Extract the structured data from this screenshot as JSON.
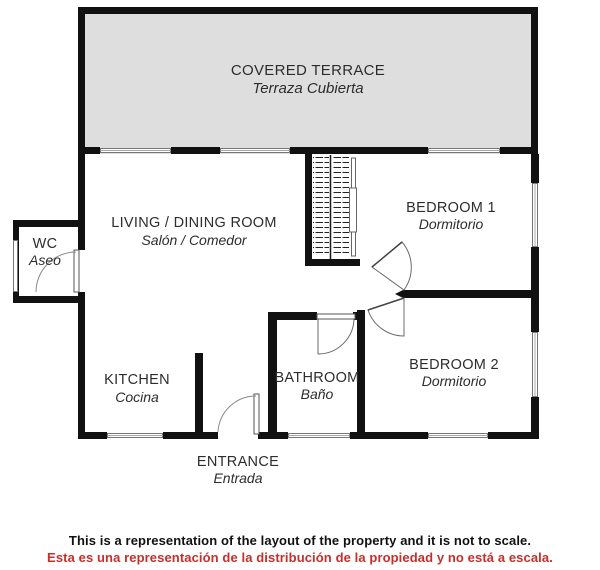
{
  "rooms": {
    "covered_terrace": {
      "label": "COVERED TERRACE",
      "sublabel": "Terraza Cubierta"
    },
    "living_dining": {
      "label": "LIVING / DINING ROOM",
      "sublabel": "Salón / Comedor"
    },
    "wc": {
      "label": "WC",
      "sublabel": "Aseo"
    },
    "bedroom1": {
      "label": "BEDROOM 1",
      "sublabel": "Dormitorio"
    },
    "bedroom2": {
      "label": "BEDROOM 2",
      "sublabel": "Dormitorio"
    },
    "kitchen": {
      "label": "KITCHEN",
      "sublabel": "Cocina"
    },
    "bathroom": {
      "label": "BATHROOM",
      "sublabel": "Baño"
    },
    "entrance": {
      "label": "ENTRANCE",
      "sublabel": "Entrada"
    }
  },
  "disclaimer": {
    "english": "This is a representation of the layout of the property and it is not to scale.",
    "spanish": "Esta es una representación de la distribución de la propiedad y no está a escala."
  },
  "colors": {
    "wall": "#111111",
    "terrace_fill": "#dedede",
    "text": "#2d2d2d",
    "disclaimer_red": "#c5302a",
    "window_stroke": "#767676",
    "door_stroke": "#6b6b6b"
  }
}
